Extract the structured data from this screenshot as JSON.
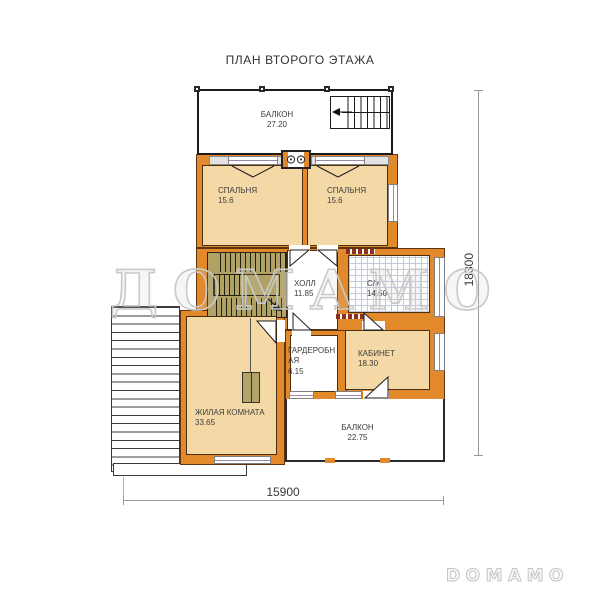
{
  "title": "ПЛАН ВТОРОГО ЭТАЖА",
  "watermark_text": "ДОМАМО",
  "brand_logo": "DOMAMO",
  "rooms": {
    "balcony_top": {
      "name": "БАЛКОН",
      "area": "27.20"
    },
    "bedroom_left": {
      "name": "СПАЛЬНЯ",
      "area": "15.6"
    },
    "bedroom_right": {
      "name": "СПАЛЬНЯ",
      "area": "15.6"
    },
    "hall": {
      "name": "ХОЛЛ",
      "area": "11.85"
    },
    "bathroom": {
      "name": "С/У",
      "area": "14.50"
    },
    "wardrobe": {
      "name": "ГАРДЕРОБНАЯ",
      "area": "6.15"
    },
    "office": {
      "name": "КАБИНЕТ",
      "area": "18.30"
    },
    "living_room": {
      "name": "ЖИЛАЯ КОМНАТА",
      "area": "33.65"
    },
    "balcony_bottom": {
      "name": "БАЛКОН",
      "area": "22.75"
    }
  },
  "dimensions": {
    "bottom": "15900",
    "right": "18300"
  },
  "colors": {
    "wall": "#E2892B",
    "room_fill": "#F4D9A6",
    "stairs_fill": "#B1A163",
    "tile_grid": "#C3CBDB",
    "vent": "#8C2F1F",
    "watermark": "#C9C9C9"
  }
}
